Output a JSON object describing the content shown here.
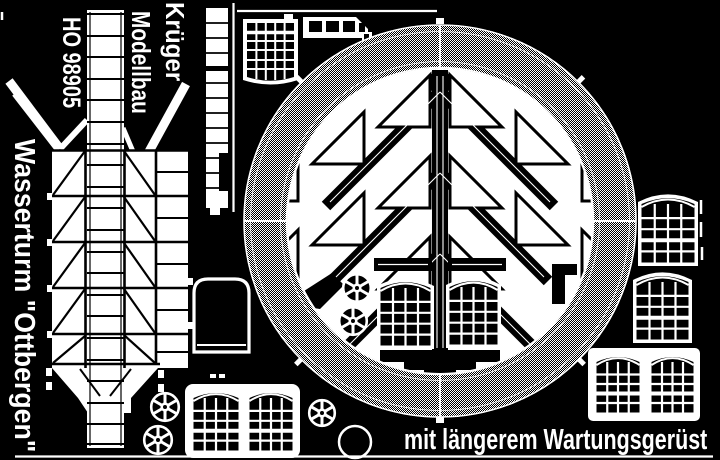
{
  "sheet": {
    "brand_line1": "Krüger",
    "brand_line2": "Modellbau",
    "product_code": "HO 98905",
    "product_name": "Wasserturm \"Ottbergen\"",
    "variant_note": "mit längerem Wartungsgerüst"
  },
  "colors": {
    "background": "#000000",
    "foreground": "#ffffff"
  }
}
